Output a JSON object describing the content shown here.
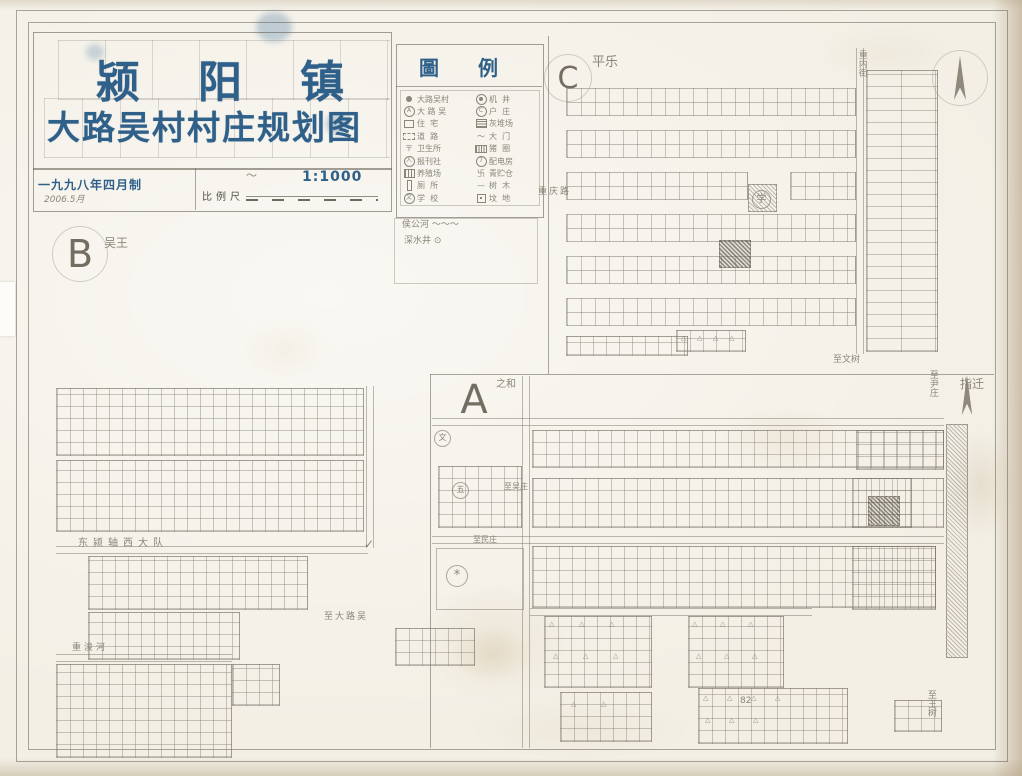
{
  "palette": {
    "ink_blue": "#2f6089",
    "pencil_gray": "#8b8679",
    "paper": "#f3efe5",
    "frame_line": "#686256"
  },
  "title_block": {
    "town_chars": [
      "颍",
      "阳",
      "镇"
    ],
    "map_title": "大路吴村村庄规划图",
    "date_line": "一九九八年四月制",
    "date_note": "2006.5月",
    "scale_label": "比例尺",
    "scale_ratio": "1:1000"
  },
  "legend": {
    "title": "圖 例",
    "entries_left": [
      {
        "sym": "dot",
        "label": "大路吴村"
      },
      {
        "sym": "circ",
        "char": "A",
        "label": "大 路 吴"
      },
      {
        "sym": "square",
        "label": "住  宅"
      },
      {
        "sym": "dashed",
        "label": "道  路"
      },
      {
        "sym": "char",
        "char": "〒",
        "label": "卫生所"
      },
      {
        "sym": "circ",
        "char": "人",
        "label": "报刊社"
      },
      {
        "sym": "grid",
        "label": "养殖场"
      },
      {
        "sym": "bar",
        "label": "厕  所"
      },
      {
        "sym": "circ",
        "char": "文",
        "label": "学  校"
      }
    ],
    "entries_right": [
      {
        "sym": "circ2",
        "label": "机  井"
      },
      {
        "sym": "circ",
        "char": "C",
        "label": "户  庄"
      },
      {
        "sym": "gridf",
        "label": "灰堆场"
      },
      {
        "sym": "char",
        "char": "～",
        "label": "大  门"
      },
      {
        "sym": "stripe",
        "label": "猪  圈"
      },
      {
        "sym": "circ",
        "char": "7",
        "label": "配电房"
      },
      {
        "sym": "char",
        "char": "卐",
        "label": "青贮仓"
      },
      {
        "sym": "char",
        "char": "—",
        "label": "树  木"
      },
      {
        "sym": "boxdot",
        "label": "坟  地"
      }
    ]
  },
  "sections": {
    "A": {
      "letter": "A"
    },
    "B": {
      "letter": "B"
    },
    "C": {
      "letter": "C"
    }
  },
  "map_labels": [
    {
      "name": "legend-note-river",
      "text": "侯公河 ～～～",
      "x": 402,
      "y": 221,
      "fs": 9
    },
    {
      "name": "legend-note-well",
      "text": "深水井 ⊙",
      "x": 404,
      "y": 237,
      "fs": 9
    },
    {
      "name": "note-pingle",
      "text": "平乐",
      "x": 592,
      "y": 56,
      "fs": 13
    },
    {
      "name": "road-label-chongqing",
      "text": "重庆路",
      "x": 538,
      "y": 188,
      "fs": 9,
      "ls": 2
    },
    {
      "name": "road-label-neijie",
      "text": "重内街",
      "x": 856,
      "y": 50,
      "fs": 9,
      "vert": true
    },
    {
      "name": "label-zhiwenshu",
      "text": "至文树",
      "x": 833,
      "y": 356,
      "fs": 9
    },
    {
      "name": "note-wuwang",
      "text": "吴王",
      "x": 104,
      "y": 237,
      "fs": 12
    },
    {
      "name": "label-dadui",
      "text": "东颍轴西大队",
      "x": 78,
      "y": 538,
      "fs": 10,
      "ls": 5
    },
    {
      "name": "label-zhidaluwu",
      "text": "至大路吴",
      "x": 324,
      "y": 613,
      "fs": 9,
      "ls": 2
    },
    {
      "name": "label-chongjunhe",
      "text": "重浚河",
      "x": 72,
      "y": 644,
      "fs": 9,
      "ls": 3
    },
    {
      "name": "note-zhihe",
      "text": "之和",
      "x": 496,
      "y": 379,
      "fs": 10
    },
    {
      "name": "note-zhiqian",
      "text": "指迁",
      "x": 960,
      "y": 378,
      "fs": 12
    },
    {
      "name": "label-zhiwuzhuang",
      "text": "至吴庄",
      "x": 504,
      "y": 483,
      "fs": 8
    },
    {
      "name": "label-zhiminzhuang",
      "text": "至民庄",
      "x": 473,
      "y": 536,
      "fs": 8
    },
    {
      "name": "label-zhiyinzhuang",
      "text": "至尹庄",
      "x": 927,
      "y": 370,
      "fs": 9,
      "vert": true
    },
    {
      "name": "label-zhiwangshu",
      "text": "至王树",
      "x": 925,
      "y": 690,
      "fs": 9,
      "vert": true
    },
    {
      "name": "note-82",
      "text": "82",
      "x": 740,
      "y": 697,
      "fs": 9
    },
    {
      "name": "check-mark",
      "text": "✓",
      "x": 364,
      "y": 538,
      "fs": 12
    },
    {
      "name": "pencil-squiggle",
      "text": "～",
      "x": 246,
      "y": 170,
      "fs": 11
    },
    {
      "name": "symbol-school",
      "text": "学",
      "x": 752,
      "y": 190,
      "fs": 10,
      "circled": true
    },
    {
      "name": "symbol-star",
      "text": "*",
      "x": 446,
      "y": 565,
      "fs": 13,
      "circled": true
    },
    {
      "name": "symbol-circle-wen",
      "text": "文",
      "x": 434,
      "y": 430,
      "fs": 8,
      "circled": true
    },
    {
      "name": "symbol-circle-wu",
      "text": "五",
      "x": 452,
      "y": 482,
      "fs": 8,
      "circled": true
    }
  ],
  "triangle_char": "△",
  "triangle_clusters": [
    {
      "x": 681,
      "y": 334,
      "count": 4,
      "gap": 16
    },
    {
      "x": 549,
      "y": 620,
      "count": 3,
      "gap": 30
    },
    {
      "x": 553,
      "y": 652,
      "count": 3,
      "gap": 30
    },
    {
      "x": 692,
      "y": 620,
      "count": 3,
      "gap": 28
    },
    {
      "x": 696,
      "y": 652,
      "count": 3,
      "gap": 28
    },
    {
      "x": 571,
      "y": 700,
      "count": 2,
      "gap": 30
    },
    {
      "x": 703,
      "y": 694,
      "count": 4,
      "gap": 24
    },
    {
      "x": 705,
      "y": 716,
      "count": 3,
      "gap": 24
    }
  ]
}
